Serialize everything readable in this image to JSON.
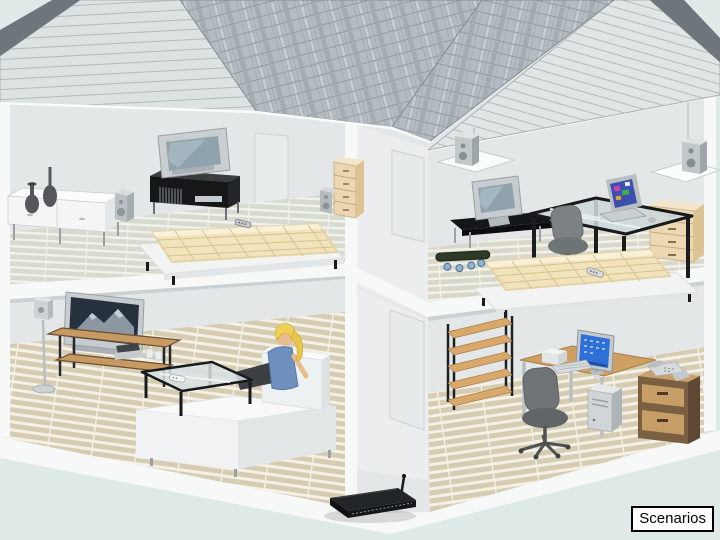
{
  "slide": {
    "caption": "Scenarios"
  },
  "colors": {
    "background": "#dfe9e7",
    "wall": "#e4e7e8",
    "wall-shaded": "#ebedee",
    "slab": "#f7f9f9",
    "gable": "#dde2e2",
    "gable-line": "#b4bbbb",
    "roof-shingle": "#b5bcc1",
    "roof-shingle-line": "#959ca2",
    "roof-edge-dark": "#6e767c",
    "floor-upper-plank": "#d7dacf",
    "floor-upper-gap": "#f0f2ec",
    "floor-lower-plank": "#d6ccb2",
    "floor-lower-gap": "#f4f1e7",
    "wood": "#d9a96b",
    "wood-dark": "#7a5f42",
    "furniture-black": "#17191b",
    "metal": "#c3c9cc",
    "mattress": "#f1e3bb",
    "mattress-line": "#d8c28f",
    "screen-blue": "#2f6fd8",
    "tv-screen-dark": "#27313d",
    "shirt-blue": "#6f8fbf",
    "hair-blonde": "#f0cf57",
    "skin": "#e9bc8e",
    "caption-bg": "#ffffff",
    "caption-border": "#000000"
  },
  "scene": {
    "rooms": [
      {
        "name": "bedroom-upper-left",
        "items": [
          "sideboard",
          "vases",
          "speaker",
          "tv-stand-with-cds",
          "crt-tv",
          "platform-bed",
          "remote-control",
          "dresser",
          "speaker"
        ]
      },
      {
        "name": "bedroom-upper-right",
        "items": [
          "ceiling-speaker",
          "ceiling-speaker",
          "crt-tv",
          "corner-tv-shelf",
          "glass-desk",
          "laptop",
          "mouse",
          "office-chair",
          "dresser",
          "skateboard",
          "platform-bed",
          "remote-control"
        ]
      },
      {
        "name": "living-room-lower-left",
        "items": [
          "floor-standing-speaker",
          "flat-tv-mountain-scene",
          "tv-bench",
          "av-equipment",
          "coffee-table",
          "remote-control",
          "sofa",
          "woman-sitting"
        ]
      },
      {
        "name": "home-office-lower-right",
        "items": [
          "shelf-unit",
          "desk",
          "monitor",
          "keyboard",
          "mouse",
          "printer",
          "office-chair",
          "pc-tower",
          "filing-cabinet",
          "telephone-fax"
        ]
      }
    ],
    "ground_floor_front": {
      "items": [
        "wireless-router"
      ]
    }
  }
}
